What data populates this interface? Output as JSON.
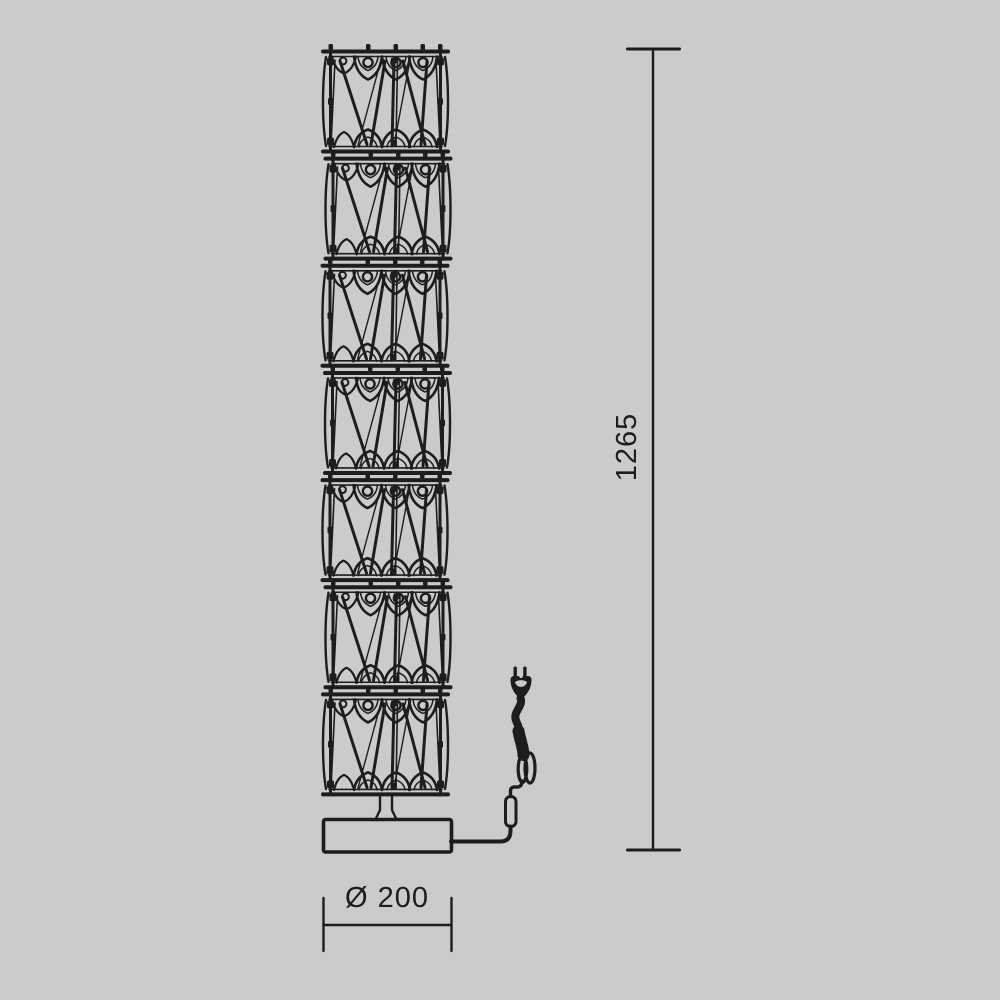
{
  "colors": {
    "background": "#cbcbcb",
    "line": "#1d1d1b"
  },
  "drawing": {
    "title": "Floor lamp technical dimension drawing",
    "style": "black line art on gray background",
    "column_segment_count": 7,
    "visible_parts": [
      "stacked crystal lattice column of 7 segments",
      "stem",
      "rectangular base (side view of round base)",
      "power cord",
      "inline switch",
      "coiled cord bundle",
      "two-prong plug"
    ]
  },
  "dimensions": {
    "height": {
      "label": "1265",
      "orientation": "vertical",
      "side": "right"
    },
    "base_diameter": {
      "label": "Ø 200",
      "orientation": "horizontal",
      "side": "bottom"
    }
  }
}
